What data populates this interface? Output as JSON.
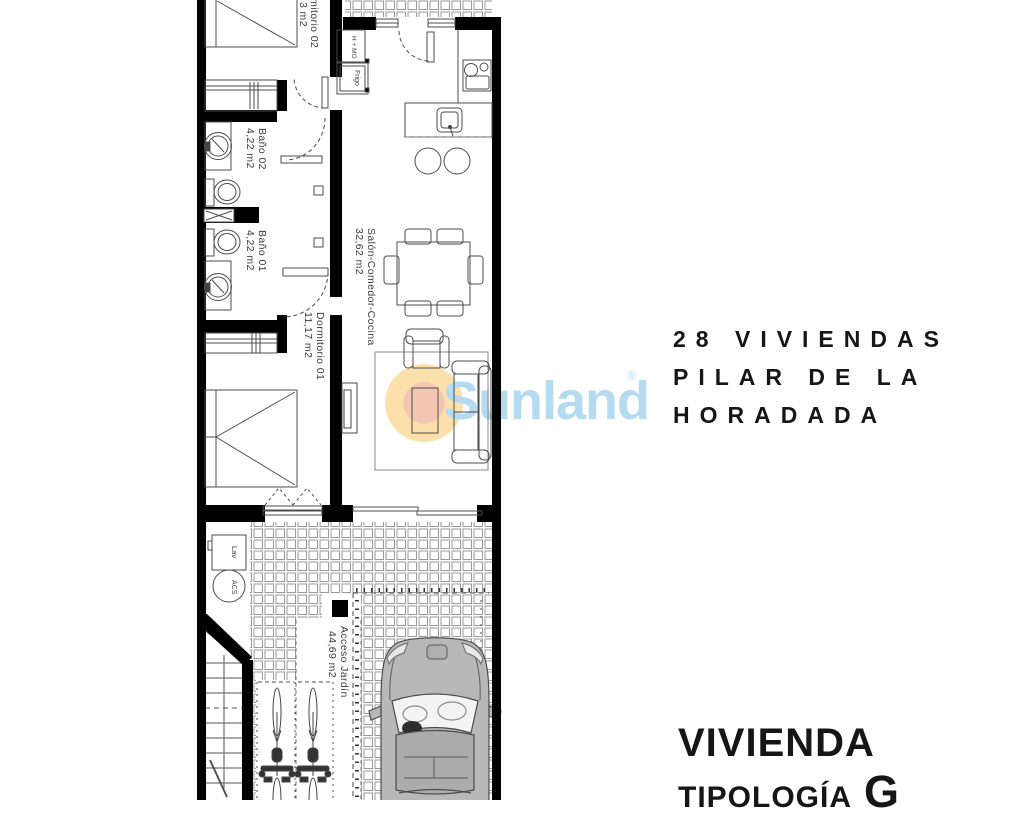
{
  "plan": {
    "rooms": [
      {
        "name": "Dormitorio 02",
        "area": "3 m2"
      },
      {
        "name": "Baño 02",
        "area": "4,22 m2"
      },
      {
        "name": "Baño 01",
        "area": "4,22 m2"
      },
      {
        "name": "Dormitorio 01",
        "area": "11,17 m2"
      },
      {
        "name": "Salón-Comedor-Cocina",
        "area": "32,62 m2"
      },
      {
        "name": "Acceso Jardín",
        "area": "44,69 m2"
      }
    ],
    "fixtures": {
      "oven_micro": "H + MO",
      "fridge": "Frigo",
      "laundry": "Lav",
      "water_heater": "ACS"
    }
  },
  "watermark": {
    "brand": "Sunland",
    "registered_mark": "®"
  },
  "title_block": {
    "project_lines": [
      "28 VIVIENDAS",
      "PILAR DE LA",
      "HORADADA"
    ],
    "unit_title": "VIVIENDA",
    "typology_label": "TIPOLOGÍA",
    "typology_value": "G"
  },
  "colors": {
    "wall": "#000000",
    "linework": "#4d4d4d",
    "tile_line": "#9a9a9a",
    "car_body": "#b8b8b8",
    "watermark_text": "#b5dbf0",
    "watermark_ring": "#fbdfa7",
    "watermark_core": "#f2c3ae",
    "heading_text": "#161616"
  }
}
